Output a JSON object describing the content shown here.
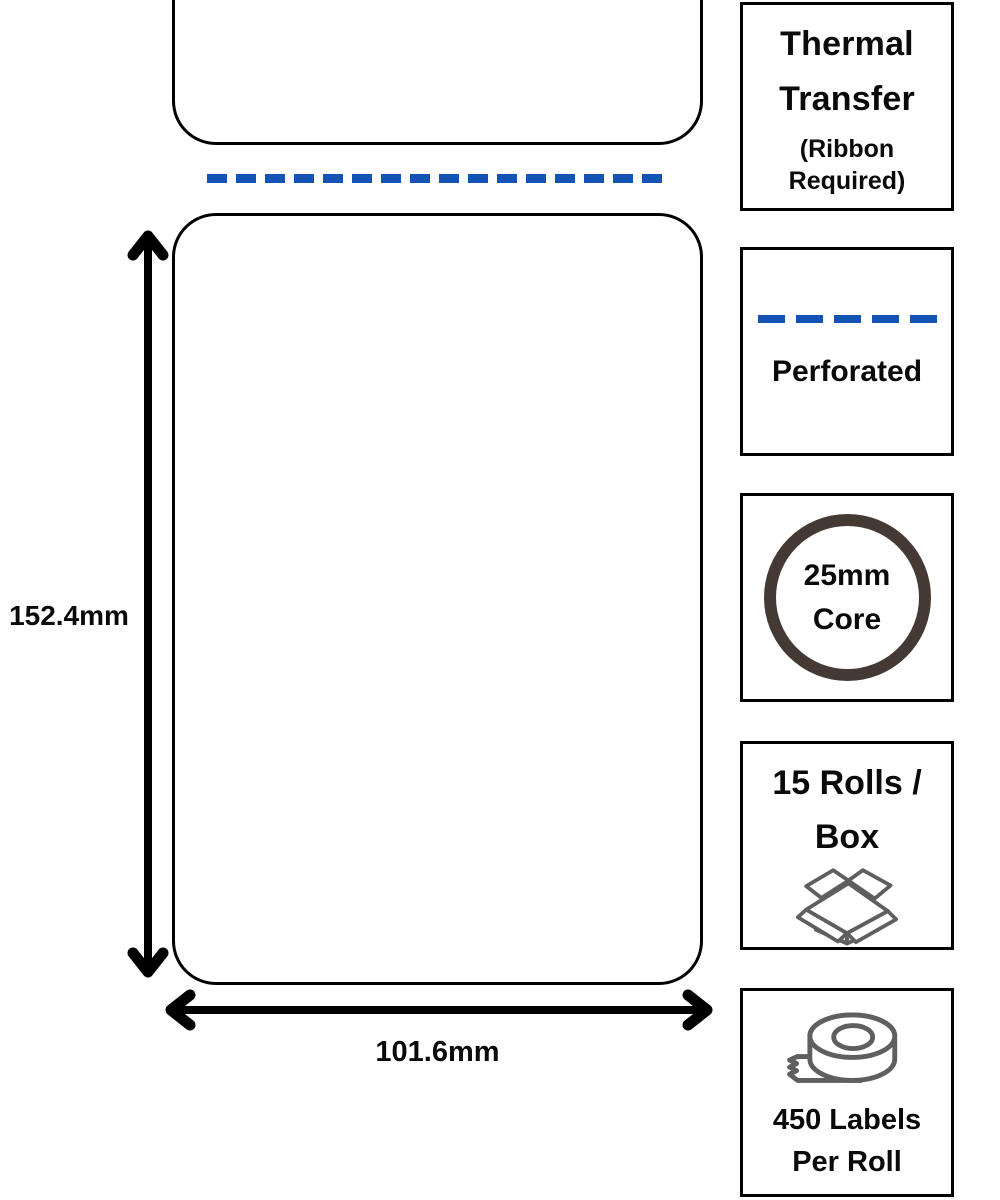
{
  "diagram": {
    "height_dimension": "152.4mm",
    "width_dimension": "101.6mm",
    "perforation_icon": "dashed-perforation-line"
  },
  "sidebar": {
    "boxes": [
      {
        "name": "thermal-transfer",
        "title_lines": [
          "Thermal",
          "Transfer"
        ],
        "subtitle_lines": [
          "(Ribbon",
          "Required)"
        ]
      },
      {
        "name": "perforated",
        "label": "Perforated",
        "icon": "dashed-perforation-line"
      },
      {
        "name": "core-size",
        "label_lines": [
          "25mm",
          "Core"
        ],
        "icon": "roll-core-ring"
      },
      {
        "name": "rolls-per-box",
        "label_lines": [
          "15 Rolls /",
          "Box"
        ],
        "icon": "open-shipping-box"
      },
      {
        "name": "labels-per-roll",
        "label_lines": [
          "450 Labels",
          "Per Roll"
        ],
        "icon": "label-tape-roll"
      }
    ]
  },
  "colors": {
    "perforation_blue": "#1253b4",
    "core_ring_brown": "#453a33",
    "icon_gray": "#5f5f5f",
    "outline_black": "#000000"
  }
}
